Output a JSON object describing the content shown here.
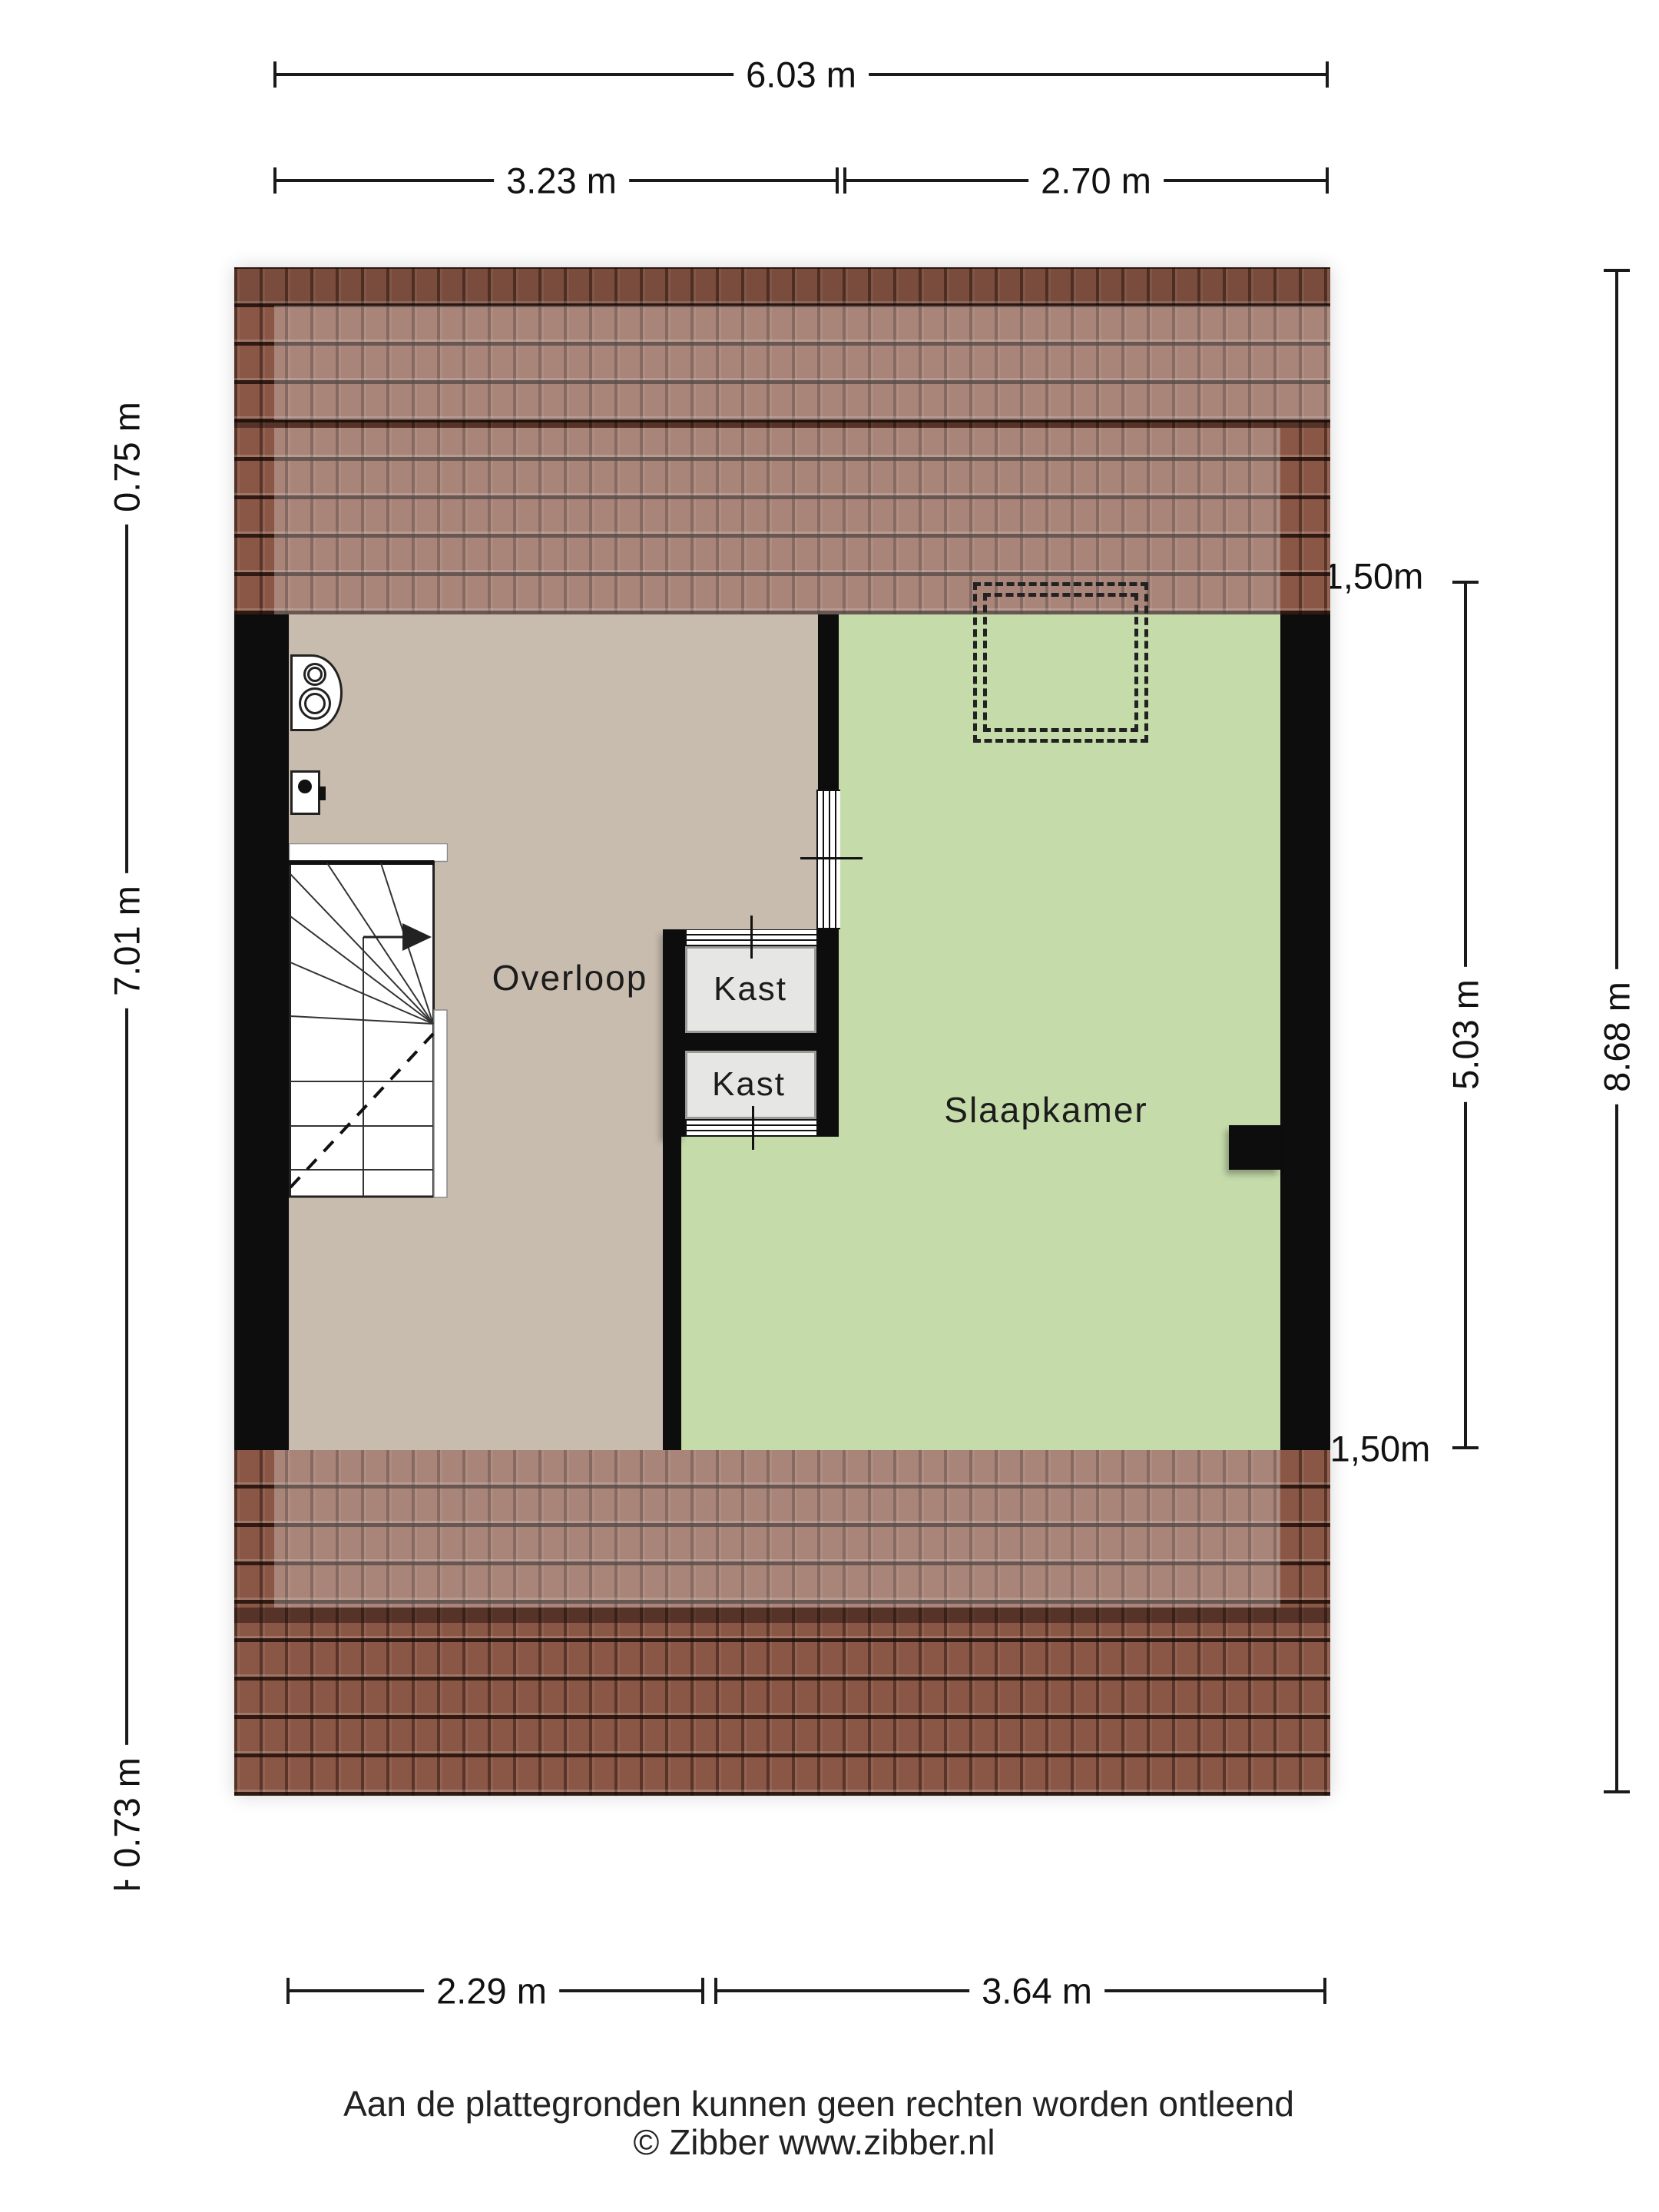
{
  "plan": {
    "rooms": [
      {
        "id": "overloop",
        "label": "Overloop"
      },
      {
        "id": "slaapkamer",
        "label": "Slaapkamer"
      },
      {
        "id": "kast-upper",
        "label": "Kast"
      },
      {
        "id": "kast-lower",
        "label": "Kast"
      }
    ],
    "features": [
      {
        "name": "winder-staircase-with-direction-arrow"
      },
      {
        "name": "dashed-dormer-outline"
      },
      {
        "name": "mechanical-ventilation-unit-icon"
      },
      {
        "name": "wall-switch-icon"
      },
      {
        "name": "roof-tile-bands-top-and-bottom"
      }
    ]
  },
  "dimensions": {
    "top_total": "6.03 m",
    "top_left": "3.23 m",
    "top_right": "2.70 m",
    "left_top": "0.75 m",
    "left_middle": "7.01 m",
    "left_bottom": "0.73 m",
    "right_contour_top": "1,50m",
    "right_inner": "5.03 m",
    "right_total": "8.68 m",
    "right_contour_bottom": "1,50m",
    "bottom_left": "2.29 m",
    "bottom_right": "3.64 m"
  },
  "footer": {
    "disclaimer": "Aan de plattegronden kunnen geen rechten worden ontleend",
    "copyright": "© Zibber www.zibber.nl"
  },
  "colors": {
    "floor_overloop": "#c8bcae",
    "floor_slaapkamer": "#c5dcaa",
    "roof_tile": "#8a5746",
    "wall": "#0d0d0d",
    "kast_fill": "#e6e6e5",
    "line": "#1a1a1a"
  }
}
